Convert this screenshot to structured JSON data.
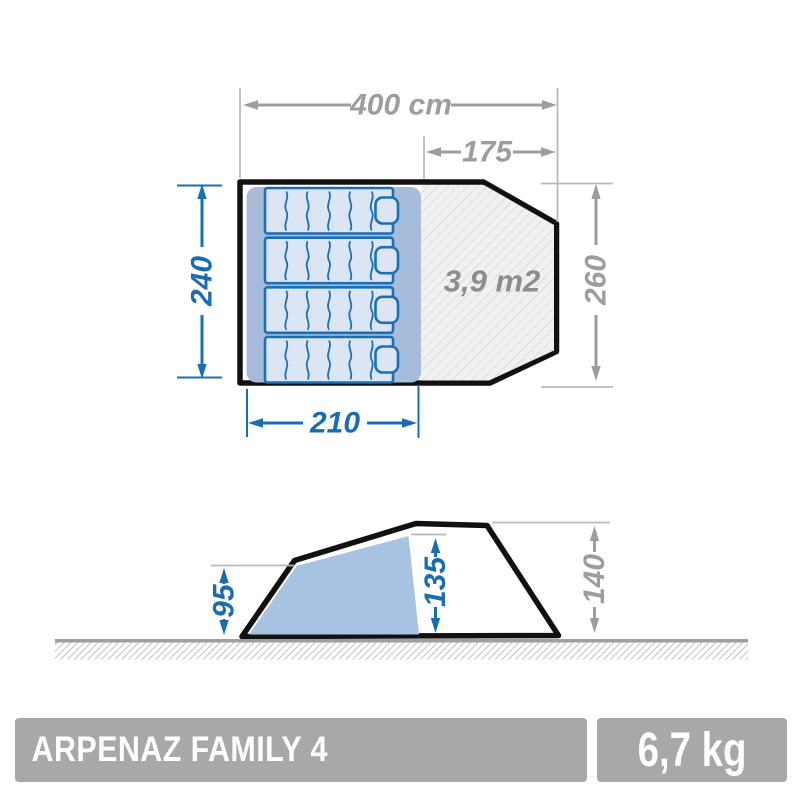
{
  "figure": {
    "top_view": {
      "area_label": "3,9 m2",
      "dim_total_width": "400 cm",
      "dim_porch_width": "175",
      "dim_bedroom_depth": "240",
      "dim_total_depth": "260",
      "dim_bedroom_width": "210"
    },
    "side_view": {
      "dim_rear_height": "95",
      "dim_inner_height": "135",
      "dim_total_height": "140"
    }
  },
  "footer": {
    "product_name": "ARPENAZ FAMILY 4",
    "weight": "6,7 kg"
  },
  "colors": {
    "dimension_blue": "#1b6db3",
    "dimension_gray": "#9d9d9d",
    "extension_line_gray": "#b9b9b9",
    "area_text_gray": "#8d8d8d",
    "tent_outline_black": "#111111",
    "bedroom_pad_fill": "#a6bcdb",
    "mattress_fill": "#dce5f3",
    "mattress_stroke": "#1a6fb5",
    "porch_hatch_bg": "#f1f1f0",
    "porch_hatch_line": "#d2d2d2",
    "side_inner_fill": "#a8c3e1",
    "ground_gray": "#9f9f9f",
    "footer_bar_gray": "#a8a8a8",
    "footer_text": "#ffffff"
  }
}
